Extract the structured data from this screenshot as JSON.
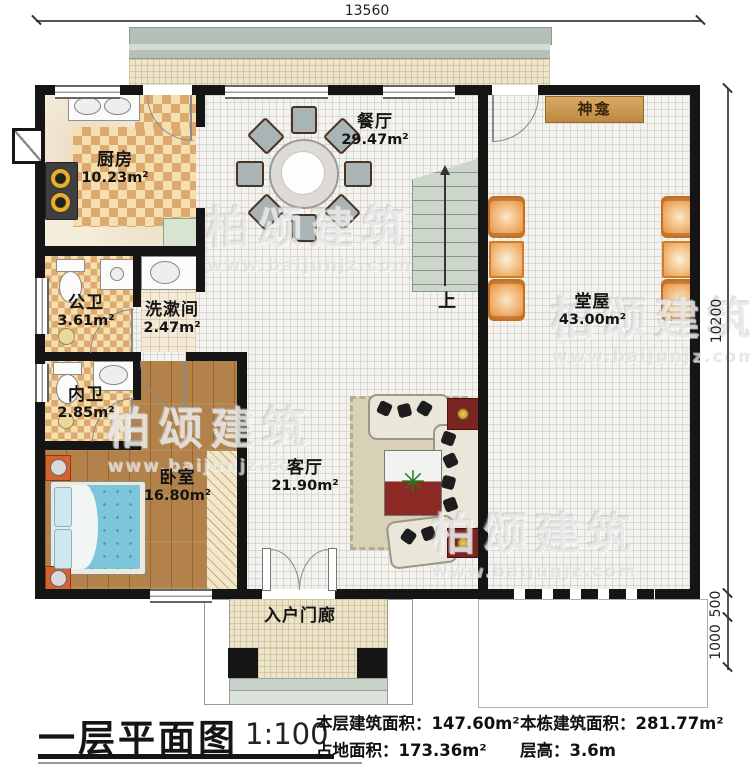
{
  "watermark": {
    "brand": "柏颂建筑",
    "url": "www.baijunjz.com"
  },
  "dimensions": {
    "top": "13560",
    "right_main": "10200",
    "right_step": "500",
    "right_porch": "1000"
  },
  "rooms": {
    "kitchen": {
      "name": "厨房",
      "area": "10.23m²"
    },
    "dining": {
      "name": "餐厅",
      "area": "29.47m²"
    },
    "hall": {
      "name": "堂屋",
      "area": "43.00m²"
    },
    "shrine": {
      "name": "神龛"
    },
    "public_bath": {
      "name": "公卫",
      "area": "3.61m²"
    },
    "washroom": {
      "name": "洗漱间",
      "area": "2.47m²"
    },
    "private_bath": {
      "name": "内卫",
      "area": "2.85m²"
    },
    "bedroom": {
      "name": "卧室",
      "area": "16.80m²"
    },
    "living": {
      "name": "客厅",
      "area": "21.90m²"
    },
    "porch": {
      "name": "入户门廊"
    },
    "stairs": {
      "direction": "上"
    }
  },
  "title_block": {
    "title": "一层平面图",
    "scale": "1:100",
    "items": [
      {
        "label": "本层建筑面积：",
        "value": "147.60m²"
      },
      {
        "label": "占地面积：",
        "value": "173.36m²"
      },
      {
        "label": "本栋建筑面积：",
        "value": "281.77m²"
      },
      {
        "label": "层高：",
        "value": "3.6m"
      }
    ]
  },
  "icons": {
    "plant": "✳"
  },
  "colors": {
    "wall": "#151515",
    "checker_dark": "#dcaa6e",
    "checker_light": "#f5dfae",
    "wood_floor": "#b2824a",
    "bed_mattress": "#7cc5da",
    "hall_chair": "#eda45c",
    "tv_cabinet": "#7b2523",
    "stair_tread": "#ccd6cb",
    "shrine": "#c9984f",
    "terrace_band": "#b5c1b7"
  }
}
